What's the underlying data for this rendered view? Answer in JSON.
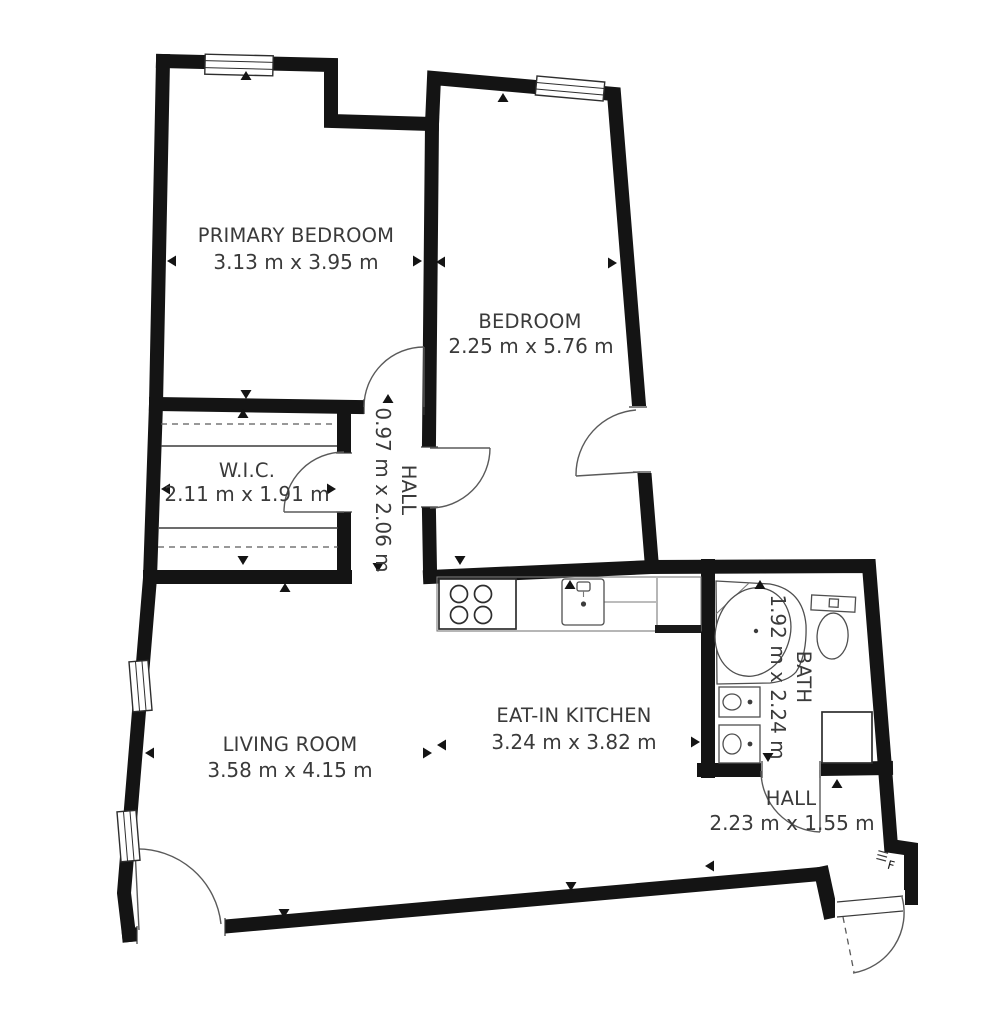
{
  "colors": {
    "wall": "#141414",
    "fixture_line": "#555555",
    "label_text": "#3a3a3a",
    "background": "#ffffff"
  },
  "units": "m",
  "rooms": [
    {
      "id": "primary-bedroom",
      "name": "PRIMARY BEDROOM",
      "dims": "3.13 m x 3.95 m"
    },
    {
      "id": "bedroom",
      "name": "BEDROOM",
      "dims": "2.25 m x 5.76 m"
    },
    {
      "id": "wic",
      "name": "W.I.C.",
      "dims": "2.11 m x 1.91 m"
    },
    {
      "id": "hall-upper",
      "name": "HALL",
      "dims": "0.97 m x 2.06 m"
    },
    {
      "id": "eat-in-kitchen",
      "name": "EAT-IN KITCHEN",
      "dims": "3.24 m x 3.82 m"
    },
    {
      "id": "living-room",
      "name": "LIVING ROOM",
      "dims": "3.58 m x 4.15 m"
    },
    {
      "id": "bath",
      "name": "BATH",
      "dims": "1.92 m x 2.24 m"
    },
    {
      "id": "hall-entry",
      "name": "HALL",
      "dims": "2.23 m x 1.55 m"
    }
  ],
  "fixtures": [
    "stove",
    "kitchen-sink",
    "kitchen-counter",
    "corner-bathtub",
    "toilet",
    "vanity-sink",
    "vanity-sink",
    "shower",
    "closet-rails"
  ],
  "annotations": {
    "entry_mark": "F"
  }
}
